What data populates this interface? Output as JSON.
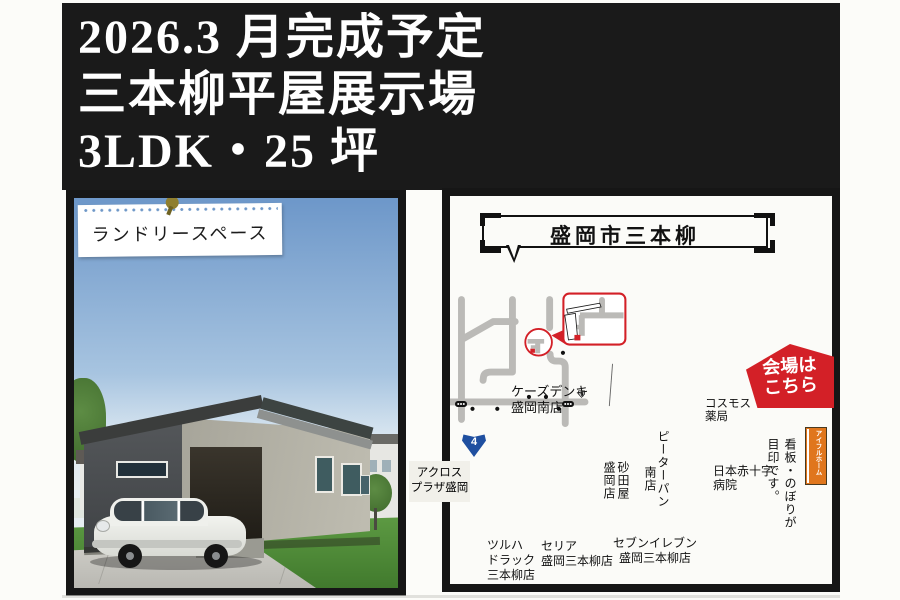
{
  "header": {
    "line1": "2026.3 月完成予定",
    "line2": "三本柳平屋展示場",
    "line3": "3LDK・25 坪"
  },
  "photo": {
    "note_label": "ランドリースペース"
  },
  "map": {
    "title": "盛岡市三本柳",
    "route_shield": "4",
    "venue_badge": {
      "line1": "会場は",
      "line2": "こちら"
    },
    "labels": {
      "ks_denki": "ケーズデンキ\n盛岡南店",
      "cosmos": "コスモス\n薬局",
      "peterpan_1": "ピーターパン",
      "peterpan_2": "南店",
      "sunadaya": "砂田屋\n盛岡店",
      "hospital": "日本赤十字\n病院",
      "across": "アクロス\nプラザ盛岡",
      "tsuruha": "ツルハ\nドラック\n三本柳店",
      "seria": "セリア\n盛岡三本柳店",
      "seven_eleven": "セブンイレブン\n盛岡三本柳店",
      "kanban": "看板・のぼりが\n目印です。",
      "flag": "アイフルホーム"
    },
    "colors": {
      "road_gray": "#bbbab7",
      "accent_red": "#d32027",
      "flag_orange": "#e0761d",
      "route_blue": "#1f4fa0"
    }
  }
}
